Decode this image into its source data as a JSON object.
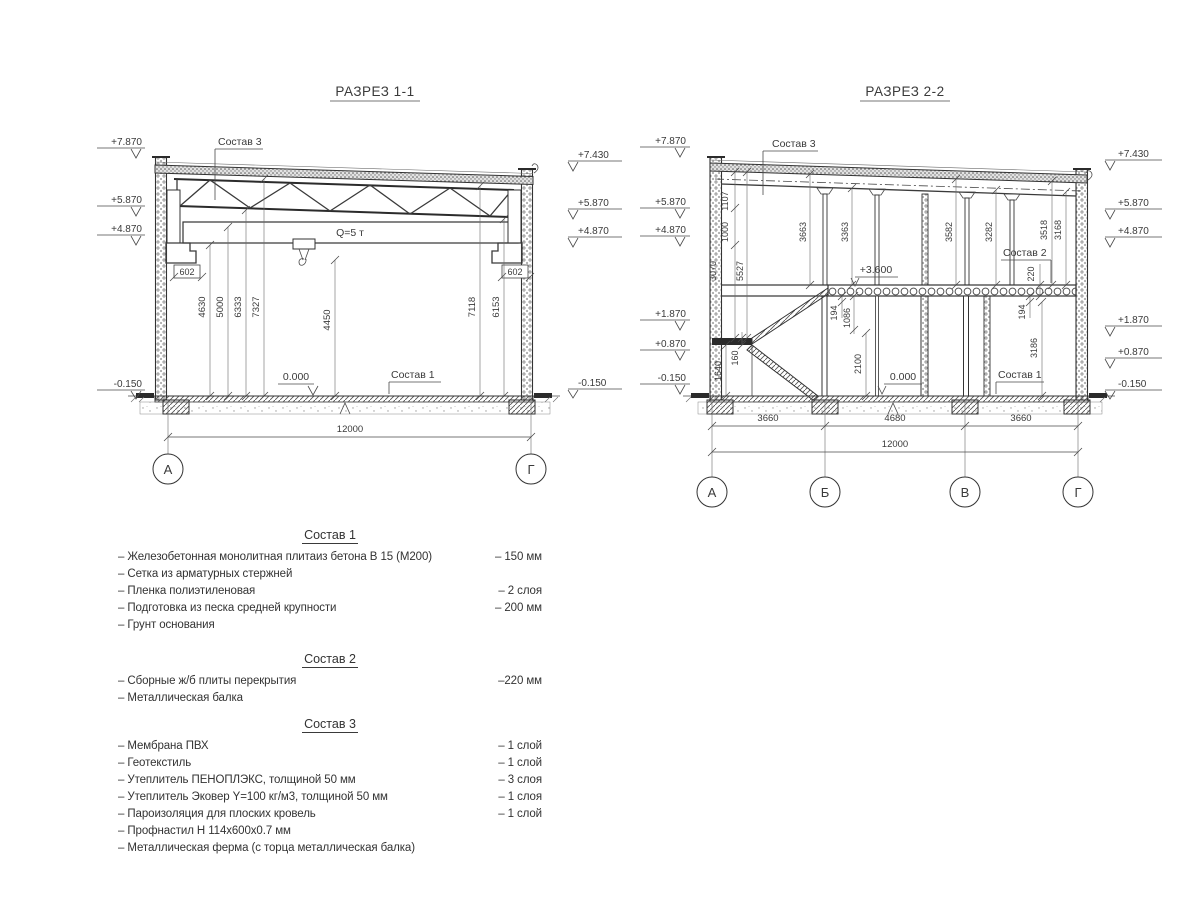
{
  "s1": {
    "title": "РАЗРЕЗ 1-1",
    "crane_label": "Q=5 т",
    "labels": {
      "sostav3": "Состав 3",
      "sostav1": "Состав 1",
      "zero": "0.000"
    },
    "elev_left": [
      "+7.870",
      "+5.870",
      "+4.870",
      "-0.150"
    ],
    "elev_right": [
      "+7.430",
      "+5.870",
      "+4.870",
      "-0.150"
    ],
    "dims": {
      "c602l": "602",
      "c602r": "602",
      "h4630": "4630",
      "h5000": "5000",
      "h6333": "6333",
      "h7327": "7327",
      "h4450": "4450",
      "h7118": "7118",
      "h6153": "6153",
      "total": "12000"
    },
    "axes": [
      "А",
      "Г"
    ]
  },
  "s2": {
    "title": "РАЗРЕЗ 2-2",
    "labels": {
      "sostav3": "Состав 3",
      "sostav2": "Состав 2",
      "sostav1": "Состав 1",
      "zero": "0.000",
      "mezz": "+3.600"
    },
    "elev_left": [
      "+7.870",
      "+5.870",
      "+4.870",
      "+1.870",
      "+0.870",
      "-0.150"
    ],
    "elev_right": [
      "+7.430",
      "+5.870",
      "+4.870",
      "+1.870",
      "+0.870",
      "-0.150"
    ],
    "dims": {
      "d1107": "1107",
      "d1000": "1000",
      "d3070": "3070",
      "d5527": "5527",
      "d3663": "3663",
      "d3363": "3363",
      "d3582": "3582",
      "d3282": "3282",
      "d3518": "3518",
      "d3168": "3168",
      "d220": "220",
      "d194L": "194",
      "d1086": "1086",
      "d2100": "2100",
      "d1640": "1640",
      "d160": "160",
      "d194R": "194",
      "d3186": "3186",
      "span1": "3660",
      "span2": "4680",
      "span3": "3660",
      "total": "12000"
    },
    "axes": [
      "А",
      "Б",
      "В",
      "Г"
    ]
  },
  "compositions": [
    {
      "title": "Состав 1",
      "items": [
        {
          "name": "– Железобетонная  монолитная плитаиз бетона В 15 (М200)",
          "value": "– 150 мм"
        },
        {
          "name": "– Сетка из арматурных стержней",
          "value": ""
        },
        {
          "name": "– Пленка полиэтиленовая",
          "value": "– 2 слоя"
        },
        {
          "name": "– Подготовка из песка средней крупности",
          "value": "– 200 мм"
        },
        {
          "name": "– Грунт основания",
          "value": ""
        }
      ]
    },
    {
      "title": "Состав 2",
      "items": [
        {
          "name": "– Сборные ж/б плиты перекрытия",
          "value": "–220 мм"
        },
        {
          "name": "– Металлическая балка",
          "value": ""
        }
      ]
    },
    {
      "title": "Состав 3",
      "items": [
        {
          "name": "– Мембрана ПВХ",
          "value": "– 1 слой"
        },
        {
          "name": "– Геотекстиль",
          "value": "– 1 слой"
        },
        {
          "name": "– Утеплитель ПЕНОПЛЭКС, толщиной 50 мм",
          "value": "– 3 слоя"
        },
        {
          "name": "– Утеплитель Эковер Y=100 кг/м3, толщиной 50 мм",
          "value": "– 1 слоя"
        },
        {
          "name": "– Пароизоляция для плоских кровель",
          "value": "– 1 слой"
        },
        {
          "name": "– Профнастил Н 114х600х0.7 мм",
          "value": ""
        },
        {
          "name": "– Металлическая ферма (с торца металлическая балка)",
          "value": ""
        }
      ]
    }
  ]
}
